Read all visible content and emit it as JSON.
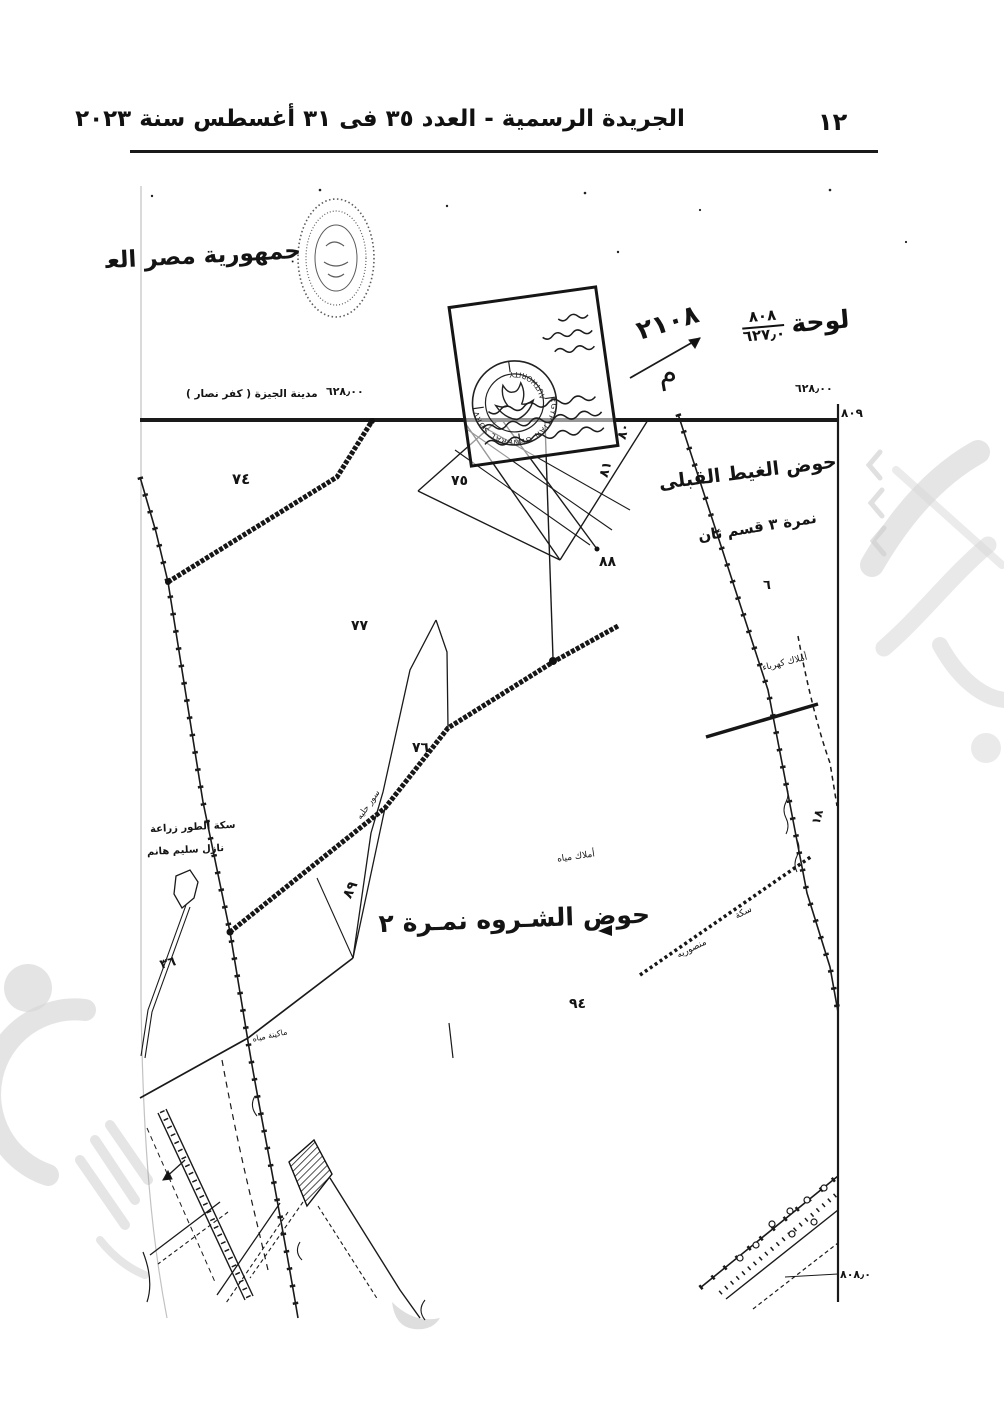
{
  "header": {
    "title": "الجريدة الرسمية - العدد ٣٥ فى ٣١ أغسطس سنة ٢٠٢٣",
    "page_number": "١٢"
  },
  "map": {
    "republic_label": "جمهورية مصر العربية",
    "plate_label": "لوحة",
    "plate_numerator": "٨٠٨",
    "plate_denominator": "٦٢٧٫٠",
    "handwritten_number": "٢١٠٨",
    "handwritten_letter": "م",
    "city_label": "مدينة الجيزة ( كفر نصار )",
    "coord_left": "٦٢٨٫٠٠",
    "coord_right": "٦٢٨٫٠٠",
    "corner_number": "٨٠٩",
    "bottom_right_number": "٨٠٨٫٠",
    "basin_east_line1": "حوض الغيط القبلى",
    "basin_east_line2": "نمرة ٣ قسم ثان",
    "basin_east_number": "٦",
    "basin_main": "حوض الشـروه نمـرة ٢",
    "stamp": {
      "arc_top": "EGYPTIAN GENERAL SURVEY",
      "arc_bottom": "AUTHORITY"
    },
    "parcels": {
      "p74": "٧٤",
      "p75": "٧٥",
      "p76": "٧٦",
      "p77": "٧٧",
      "p80": "٨٠",
      "p81": "٨١",
      "p88": "٨٨",
      "p89": "٨٩",
      "p94": "٩٤",
      "p36": "٣٦",
      "p18": "١٨"
    },
    "annotations": {
      "railway_line1": "سكة الطور زراعة",
      "railway_line2": "نازل سليم هانم",
      "wall": "سور حليه",
      "water_props": "أملاك مياه",
      "electric_props": "أملاك كهرباء",
      "track": "سكة",
      "mansouriya": "منصوريه",
      "water_machine": "ماكينة مياه"
    }
  }
}
